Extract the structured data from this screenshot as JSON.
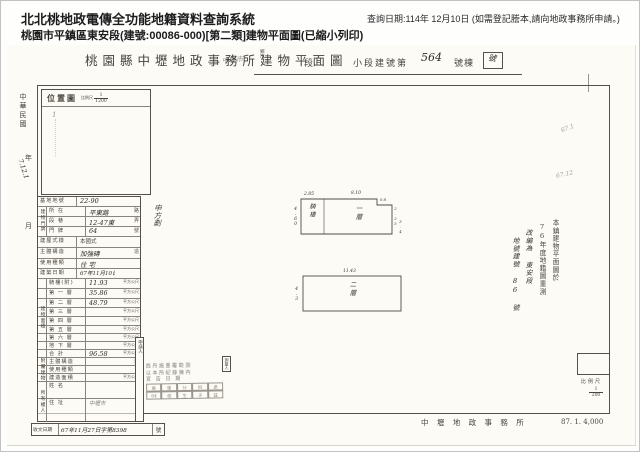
{
  "header": {
    "system_title": "北北桃地政電傳全功能地籍資料查詢系統",
    "query_date": "查詢日期:114年 12月10日 (如需登記謄本,請向地政事務所申請。)",
    "subtitle": "桃園市平鎮區東安段(建號:00086-000)[第二類]建物平面圖(已縮小列印)"
  },
  "doc": {
    "title": "桃園縣中壢地政事務所建物平面圖",
    "fields": {
      "township": [
        "鄉",
        "市"
      ],
      "hw_city": "中壢市",
      "section": "段",
      "subsection": "小段建號第",
      "building_no": "564",
      "suffix": "號棟",
      "boxed": "號"
    },
    "margin": {
      "era": "中華民國",
      "year": "年",
      "stamp": "7.12.1",
      "month": "月"
    },
    "location": {
      "label": "位置圖",
      "scale_label": "比例尺",
      "scale_num": "1",
      "scale_den": "1200",
      "hw_mark": "1"
    },
    "side_note": "申方劃",
    "table": {
      "groups": {
        "door": "建物門牌",
        "area": "建物面積",
        "annex": "附屬建物",
        "owner": "所有權人"
      },
      "rows": [
        {
          "label": "基地地號",
          "value": "22-90",
          "suffix": ""
        },
        {
          "label": "所 在",
          "value": "平東路",
          "suffix": "路"
        },
        {
          "label": "段 巷",
          "value": "12-47東",
          "suffix": "弄"
        },
        {
          "label": "門 牌",
          "value": "64",
          "suffix": "號"
        },
        {
          "label": "建屋式樣",
          "value": "本國式",
          "suffix": ""
        },
        {
          "label": "主體構造",
          "value": "加強磚",
          "suffix": "造"
        },
        {
          "label": "使用種類",
          "value": "住 宅",
          "suffix": ""
        },
        {
          "label": "建築日期",
          "value": "67年11月10日",
          "suffix": ""
        },
        {
          "label": "騎樓(附)",
          "value": "11.93",
          "suffix": "平方公尺"
        },
        {
          "label": "第 一 層",
          "value": "35.86",
          "suffix": "平方公尺"
        },
        {
          "label": "第 二 層",
          "value": "48.79",
          "suffix": "平方公尺"
        },
        {
          "label": "第 三 層",
          "value": "",
          "suffix": "平方公尺"
        },
        {
          "label": "第 四 層",
          "value": "",
          "suffix": "平方公尺"
        },
        {
          "label": "第 五 層",
          "value": "",
          "suffix": "平方公尺"
        },
        {
          "label": "第 六 層",
          "value": "",
          "suffix": "平方公尺"
        },
        {
          "label": "地 下 層",
          "value": "",
          "suffix": "平方公尺"
        },
        {
          "label": "合 計",
          "value": "96.58",
          "suffix": "平方公尺"
        },
        {
          "label": "主體構造",
          "value": "",
          "suffix": "造"
        },
        {
          "label": "使用種類",
          "value": "",
          "suffix": ""
        },
        {
          "label": "建造面積",
          "value": "",
          "suffix": "平方公尺"
        },
        {
          "label": "姓 名",
          "value": "",
          "suffix": ""
        },
        {
          "label": "住 址",
          "value": "中壢市",
          "suffix": ""
        }
      ]
    },
    "receipt": {
      "label": "收文日期",
      "value": "67年11月27日字第8398",
      "suffix": "號"
    },
    "stamp": {
      "tab_left": "申請人",
      "tab_right": "測量人",
      "lines": [
        "西丹施量覆勘測",
        "以本所紀錄棟內",
        "宣 告 日 期"
      ],
      "grid": [
        [
          "座",
          "後",
          "分",
          "科",
          "途"
        ],
        [
          "04",
          "校",
          "生",
          "子",
          "玆"
        ]
      ]
    },
    "plans": {
      "p1": {
        "side_label": "騎樓",
        "label": "一層",
        "dim_top_left": "2.85",
        "dim_top": "8.10",
        "dim_left": "4.60",
        "dim_notch": "0.8",
        "dim_notch_side": "2.25",
        "dim_right": "3.4"
      },
      "p2": {
        "label": "二層",
        "dim_top": "11.43",
        "dim_left": "4.3"
      }
    },
    "annotation": [
      "本鎮建物平面圖於",
      "76年度地籍圖重測",
      "改編為 東安段",
      "地號建號 86 號"
    ],
    "pencil_marks": [
      "67.1",
      "67.12"
    ],
    "corner_scale": {
      "label": "比例尺",
      "num": "1",
      "den": "200"
    },
    "footer": {
      "office": "中 壢 地 政 事 務 所",
      "code": "87. 1. 4,000"
    }
  }
}
